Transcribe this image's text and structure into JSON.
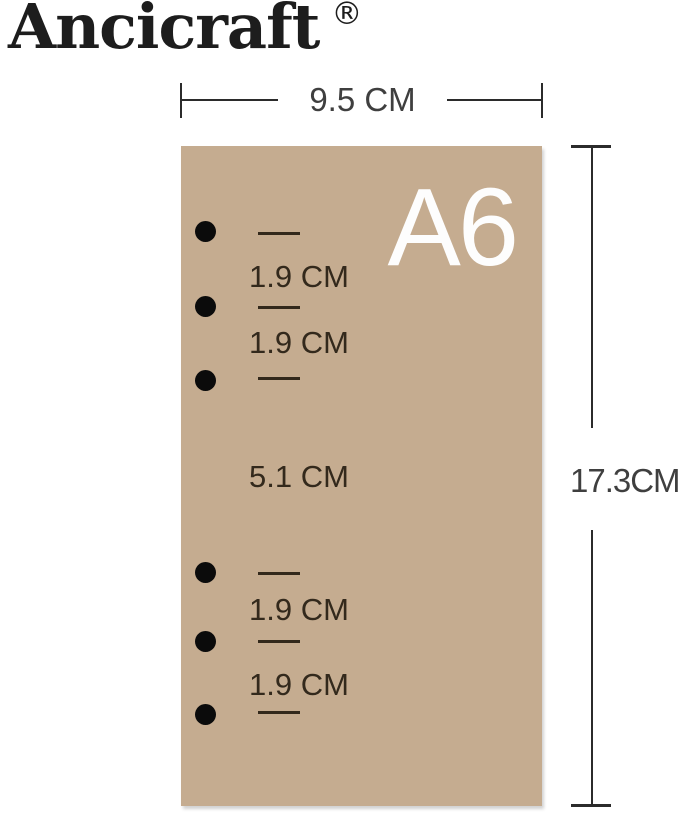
{
  "brand": {
    "name": "Ancicraft",
    "trademark": "®"
  },
  "sheet": {
    "size_label": "A6",
    "fill_color": "#c5ac90",
    "label_color": "#fdfdfd",
    "hole_color": "#0b0b0b",
    "hole_count": 6
  },
  "dimensions": {
    "width_label": "9.5 CM",
    "height_label": "17.3CM",
    "line_color": "#2b2b2b",
    "text_color": "#3f3f3f"
  },
  "spacings": {
    "top": [
      "1.9 CM",
      "1.9 CM"
    ],
    "middle": "5.1 CM",
    "bottom": [
      "1.9 CM",
      "1.9 CM"
    ],
    "text_color": "#33291c"
  }
}
